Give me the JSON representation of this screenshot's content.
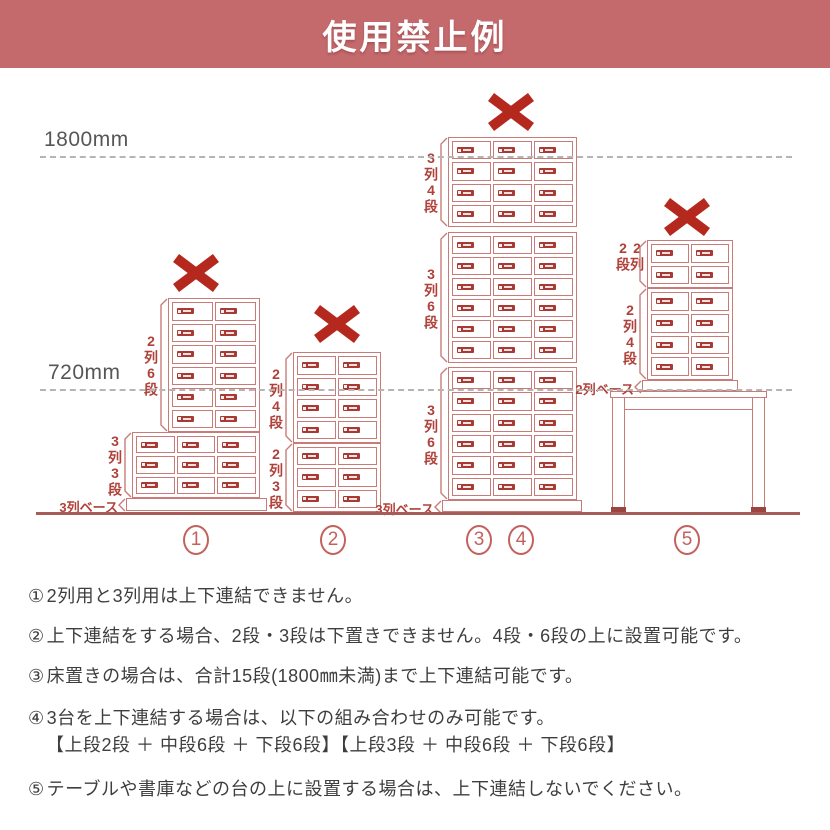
{
  "header": {
    "title": "使用禁止例",
    "bg": "#c4696c"
  },
  "diagram": {
    "colors": {
      "outline": "#c97c77",
      "badge": "#a83a33",
      "cross": "#b5281e",
      "label": "#b0413a",
      "guide": "#b5b5b5",
      "floor": "#a85c57"
    },
    "guides": [
      {
        "label": "1800mm",
        "label_x": 44,
        "label_y": 128,
        "line_y": 156,
        "x1": 40,
        "x2": 792
      },
      {
        "label": "720mm",
        "label_x": 48,
        "label_y": 361,
        "line_y": 389,
        "x1": 40,
        "x2": 792
      }
    ],
    "floor": {
      "y": 512,
      "x1": 36,
      "x2": 800
    },
    "stacks": [
      {
        "id": "1",
        "cross": {
          "cx": 196,
          "cy": 273
        },
        "units": [
          {
            "label": "2列6段",
            "cols": 2,
            "rows": 6,
            "x": 168,
            "y": 298,
            "w": 92,
            "h": 134
          },
          {
            "label": "3列3段",
            "cols": 3,
            "rows": 3,
            "x": 132,
            "y": 432,
            "w": 128,
            "h": 66
          }
        ],
        "base": {
          "x": 126,
          "y": 498,
          "w": 141,
          "h": 13,
          "label": "3列ベース"
        }
      },
      {
        "id": "2",
        "cross": {
          "cx": 337,
          "cy": 324
        },
        "units": [
          {
            "label": "2列4段",
            "cols": 2,
            "rows": 4,
            "x": 293,
            "y": 352,
            "w": 88,
            "h": 91
          },
          {
            "label": "2列3段",
            "cols": 2,
            "rows": 3,
            "x": 293,
            "y": 443,
            "w": 88,
            "h": 69
          }
        ]
      },
      {
        "id": "3-4",
        "cross": {
          "cx": 511,
          "cy": 112
        },
        "units": [
          {
            "label": "3列4段",
            "cols": 3,
            "rows": 4,
            "x": 448,
            "y": 137,
            "w": 129,
            "h": 90
          },
          {
            "label": "3列6段",
            "cols": 3,
            "rows": 6,
            "x": 448,
            "y": 232,
            "w": 129,
            "h": 131
          },
          {
            "label": "3列6段",
            "cols": 3,
            "rows": 6,
            "x": 448,
            "y": 367,
            "w": 129,
            "h": 133
          }
        ],
        "base": {
          "x": 442,
          "y": 500,
          "w": 140,
          "h": 12,
          "label": "3列ベース"
        }
      },
      {
        "id": "5",
        "cross": {
          "cx": 687,
          "cy": 217
        },
        "units": [
          {
            "label": "2列2段",
            "cols": 2,
            "rows": 2,
            "x": 647,
            "y": 240,
            "w": 86,
            "h": 48
          },
          {
            "label": "2列4段",
            "cols": 2,
            "rows": 4,
            "x": 647,
            "y": 288,
            "w": 86,
            "h": 92
          }
        ],
        "base": {
          "x": 642,
          "y": 380,
          "w": 96,
          "h": 11,
          "label": "2列ベース"
        },
        "table": {
          "x": 610,
          "y": 391,
          "w": 157,
          "slab_h": 7,
          "leg_w": 13,
          "leg_bottom": 511,
          "apron_y": 409,
          "foot_h": 5
        }
      }
    ],
    "numbers": [
      {
        "value": "1",
        "cx": 196
      },
      {
        "value": "2",
        "cx": 333
      },
      {
        "value": "3",
        "cx": 479
      },
      {
        "value": "4",
        "cx": 521
      },
      {
        "value": "5",
        "cx": 687
      }
    ],
    "numbers_cy": 540
  },
  "notes": {
    "items": [
      {
        "num": "①",
        "text": "2列用と3列用は上下連結できません。"
      },
      {
        "num": "②",
        "text": "上下連結をする場合、2段・3段は下置きできません。4段・6段の上に設置可能です。"
      },
      {
        "num": "③",
        "text": "床置きの場合は、合計15段(1800㎜未満)まで上下連結可能です。"
      },
      {
        "num": "④",
        "text": "3台を上下連結する場合は、以下の組み合わせのみ可能です。",
        "sub": "【上段2段 ＋ 中段6段 ＋ 下段6段】【上段3段 ＋ 中段6段 ＋ 下段6段】"
      },
      {
        "num": "⑤",
        "text": "テーブルや書庫などの台の上に設置する場合は、上下連結しないでください。"
      }
    ]
  }
}
